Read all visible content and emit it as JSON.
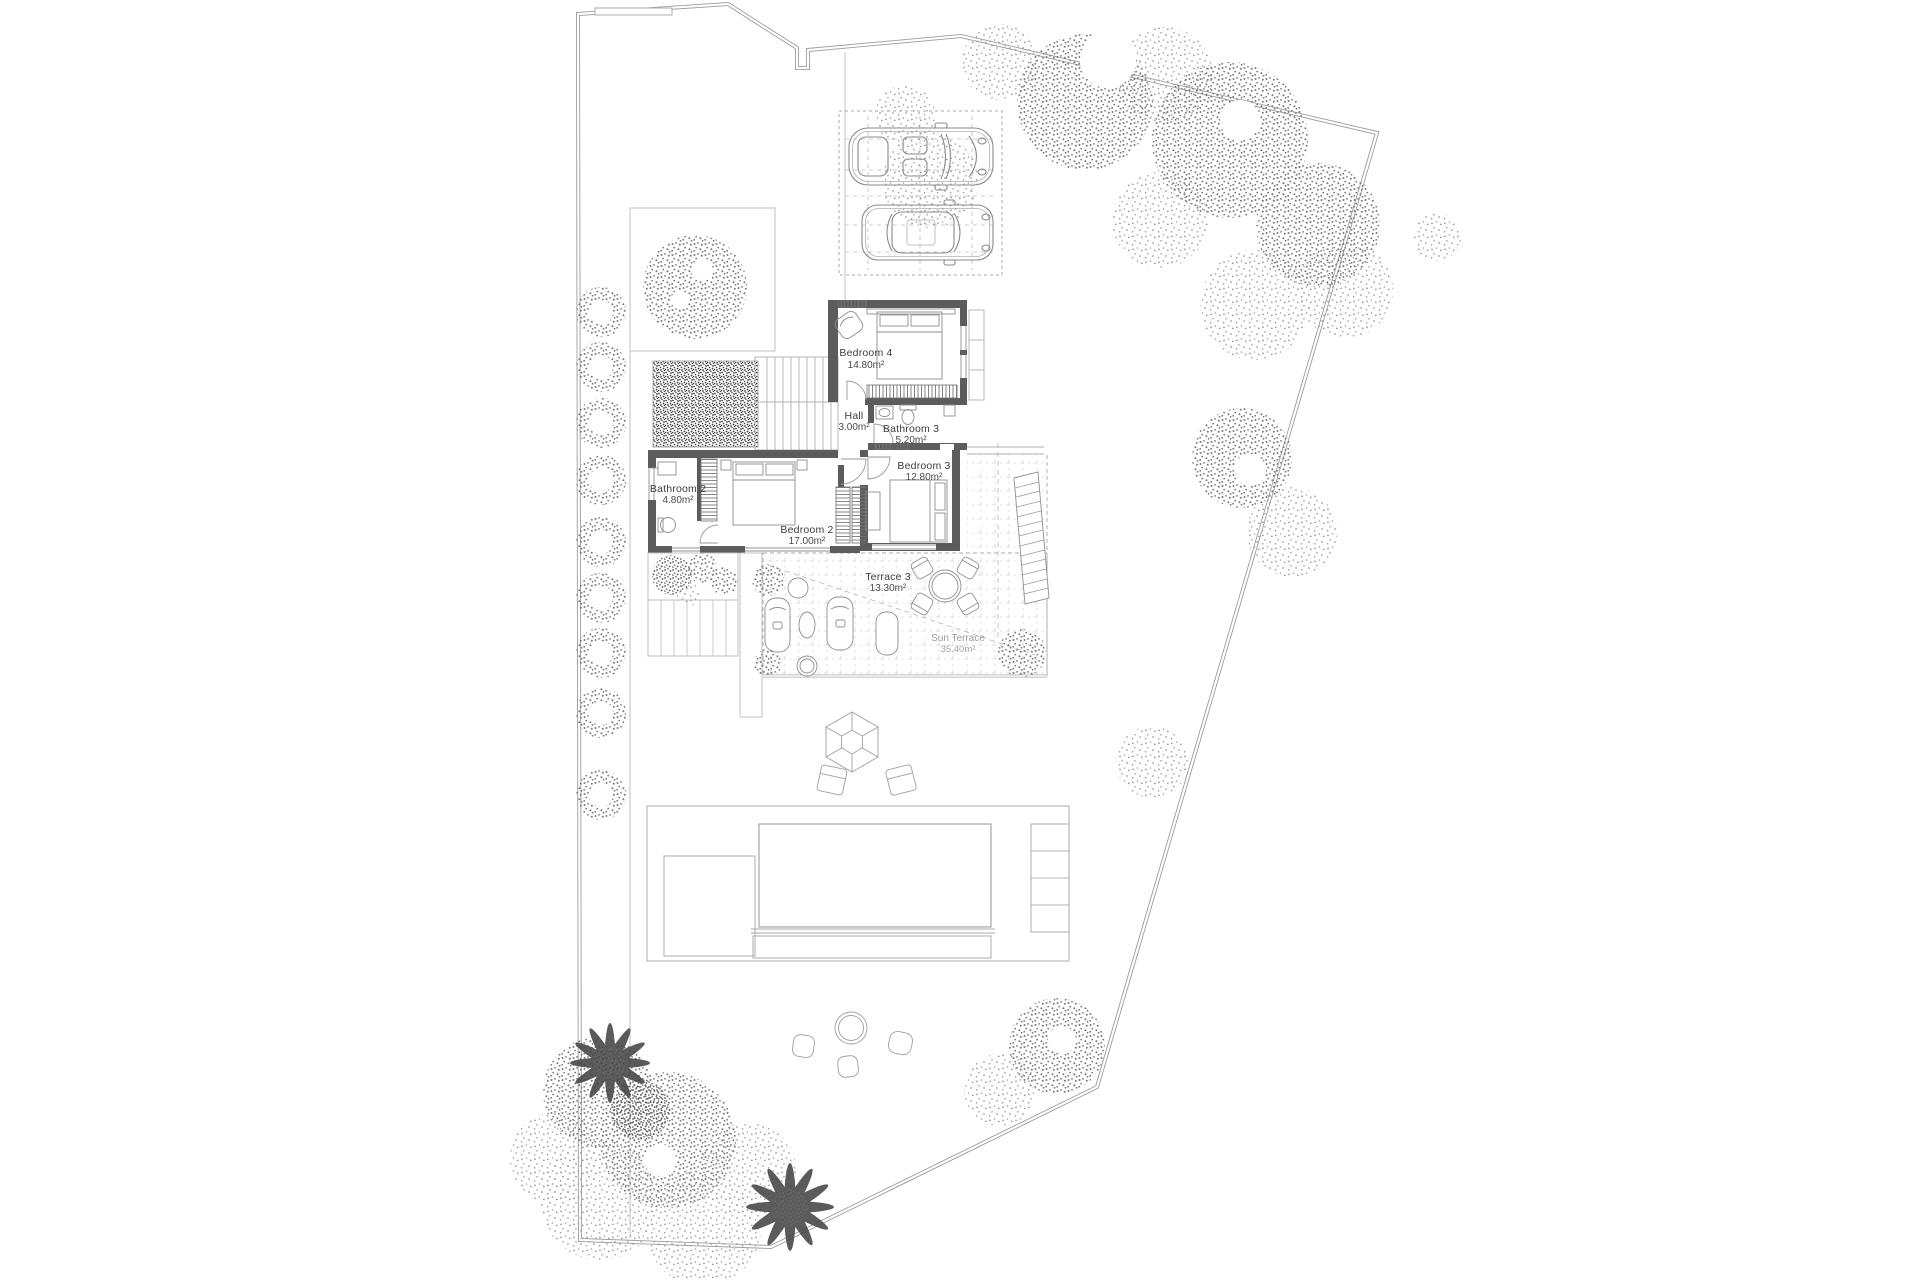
{
  "plan": {
    "title": "Villa site plan – upper floor",
    "rooms": [
      {
        "id": "bedroom-4",
        "name": "Bedroom 4",
        "area": "14.80m²"
      },
      {
        "id": "hall",
        "name": "Hall",
        "area": "3.00m²"
      },
      {
        "id": "bathroom-3",
        "name": "Bathroom 3",
        "area": "5.20m²"
      },
      {
        "id": "bedroom-3",
        "name": "Bedroom 3",
        "area": "12.80m²"
      },
      {
        "id": "bathroom-2",
        "name": "Bathroom 2",
        "area": "4.80m²"
      },
      {
        "id": "bedroom-2",
        "name": "Bedroom 2",
        "area": "17.00m²"
      },
      {
        "id": "terrace-3",
        "name": "Terrace 3",
        "area": "13.30m²"
      },
      {
        "id": "sun-terrace",
        "name": "Sun Terrace",
        "area": "35.40m²"
      }
    ],
    "colors": {
      "background": "#ffffff",
      "boundary": "#9c9c9c",
      "garden_line": "#c2c2c2",
      "wall": "#5c5c5c",
      "furniture_line": "#8f8f8f",
      "label": "#3d3d3d",
      "label_faint": "#9b9b9b",
      "foliage": "#7a7a7a"
    }
  }
}
